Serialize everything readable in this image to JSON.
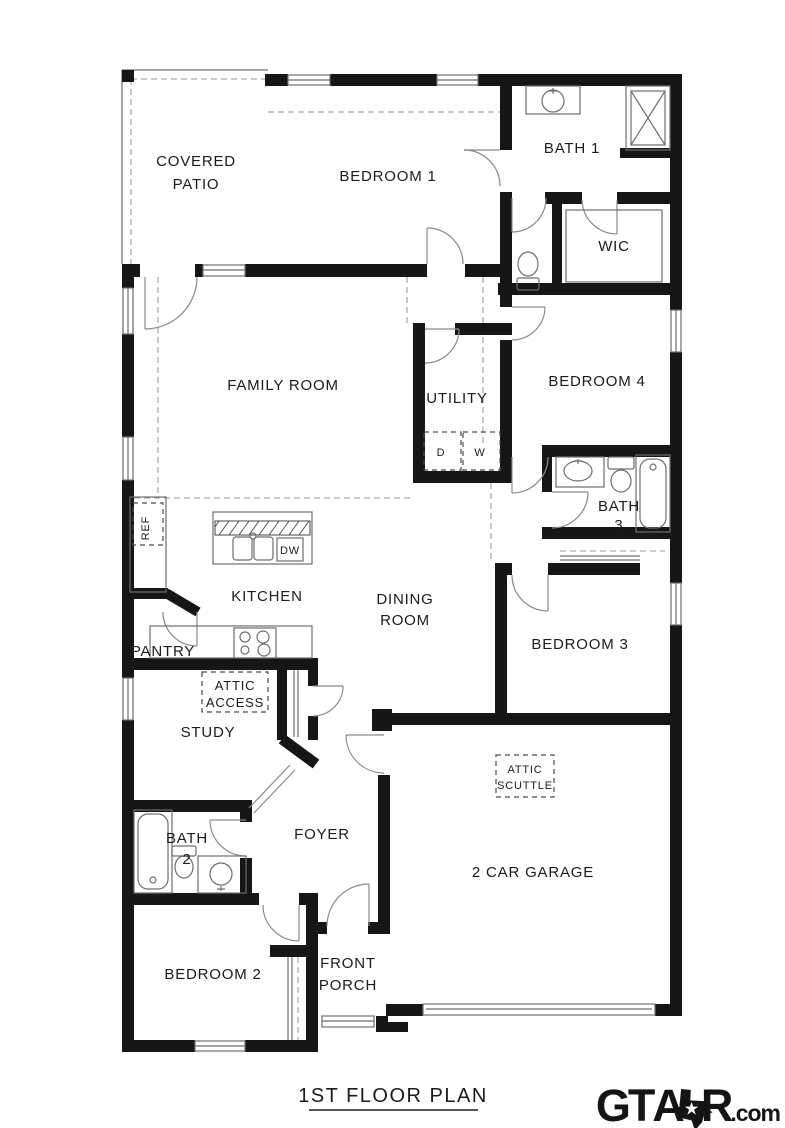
{
  "plan": {
    "title": "1ST FLOOR PLAN",
    "wall_color": "#161616",
    "line_color": "#6e6e6e",
    "background": "#ffffff"
  },
  "brand": {
    "gt": "GT",
    "a": "A",
    "r": "R",
    "suffix": ".com",
    "color": "#141414",
    "icon": "texas-star-icon"
  },
  "fixture_icons": [
    "shower-icon",
    "bathtub-icon",
    "toilet-icon",
    "sink-icon",
    "double-sink-icon",
    "stove-icon",
    "dishwasher-box",
    "refrigerator-box",
    "washer-box",
    "dryer-box",
    "door-swing-icon",
    "window-icon",
    "garage-door-icon",
    "porch-steps-icon"
  ],
  "labels": [
    {
      "name": "covered-patio-1",
      "text": "COVERED",
      "x": 196,
      "y": 166,
      "size": 15
    },
    {
      "name": "covered-patio-2",
      "text": "PATIO",
      "x": 196,
      "y": 189,
      "size": 15
    },
    {
      "name": "bedroom-1",
      "text": "BEDROOM 1",
      "x": 388,
      "y": 181,
      "size": 15
    },
    {
      "name": "bath-1",
      "text": "BATH 1",
      "x": 572,
      "y": 153,
      "size": 15
    },
    {
      "name": "wic",
      "text": "WIC",
      "x": 614,
      "y": 251,
      "size": 15
    },
    {
      "name": "family-room",
      "text": "FAMILY ROOM",
      "x": 283,
      "y": 390,
      "size": 15
    },
    {
      "name": "utility",
      "text": "UTILITY",
      "x": 457,
      "y": 403,
      "size": 15
    },
    {
      "name": "bedroom-4",
      "text": "BEDROOM 4",
      "x": 597,
      "y": 386,
      "size": 15
    },
    {
      "name": "dryer",
      "text": "D",
      "x": 441,
      "y": 456,
      "size": 11
    },
    {
      "name": "washer",
      "text": "W",
      "x": 480,
      "y": 456,
      "size": 11
    },
    {
      "name": "bath-3-1",
      "text": "BATH",
      "x": 619,
      "y": 511,
      "size": 15
    },
    {
      "name": "bath-3-2",
      "text": "3",
      "x": 619,
      "y": 530,
      "size": 15
    },
    {
      "name": "ref",
      "text": "REF",
      "x": 149,
      "y": 528,
      "size": 11,
      "rotate": -90
    },
    {
      "name": "dishwasher",
      "text": "DW",
      "x": 290,
      "y": 554,
      "size": 11
    },
    {
      "name": "kitchen",
      "text": "KITCHEN",
      "x": 267,
      "y": 601,
      "size": 15
    },
    {
      "name": "dining-room-1",
      "text": "DINING",
      "x": 405,
      "y": 604,
      "size": 15
    },
    {
      "name": "dining-room-2",
      "text": "ROOM",
      "x": 405,
      "y": 625,
      "size": 15
    },
    {
      "name": "bedroom-3",
      "text": "BEDROOM 3",
      "x": 580,
      "y": 649,
      "size": 15
    },
    {
      "name": "pantry",
      "text": "PANTRY",
      "x": 163,
      "y": 656,
      "size": 15
    },
    {
      "name": "attic-access-1",
      "text": "ATTIC",
      "x": 235,
      "y": 690,
      "size": 13
    },
    {
      "name": "attic-access-2",
      "text": "ACCESS",
      "x": 235,
      "y": 707,
      "size": 13
    },
    {
      "name": "study",
      "text": "STUDY",
      "x": 208,
      "y": 737,
      "size": 15
    },
    {
      "name": "attic-scuttle-1",
      "text": "ATTIC",
      "x": 525,
      "y": 773,
      "size": 11
    },
    {
      "name": "attic-scuttle-2",
      "text": "SCUTTLE",
      "x": 525,
      "y": 789,
      "size": 11
    },
    {
      "name": "garage",
      "text": "2 CAR GARAGE",
      "x": 533,
      "y": 877,
      "size": 15
    },
    {
      "name": "bath-2-1",
      "text": "BATH",
      "x": 187,
      "y": 843,
      "size": 15
    },
    {
      "name": "bath-2-2",
      "text": "2",
      "x": 187,
      "y": 864,
      "size": 15
    },
    {
      "name": "foyer",
      "text": "FOYER",
      "x": 322,
      "y": 839,
      "size": 15
    },
    {
      "name": "bedroom-2",
      "text": "BEDROOM 2",
      "x": 213,
      "y": 979,
      "size": 15
    },
    {
      "name": "front-porch-1",
      "text": "FRONT",
      "x": 348,
      "y": 968,
      "size": 15
    },
    {
      "name": "front-porch-2",
      "text": "PORCH",
      "x": 348,
      "y": 990,
      "size": 15
    }
  ]
}
